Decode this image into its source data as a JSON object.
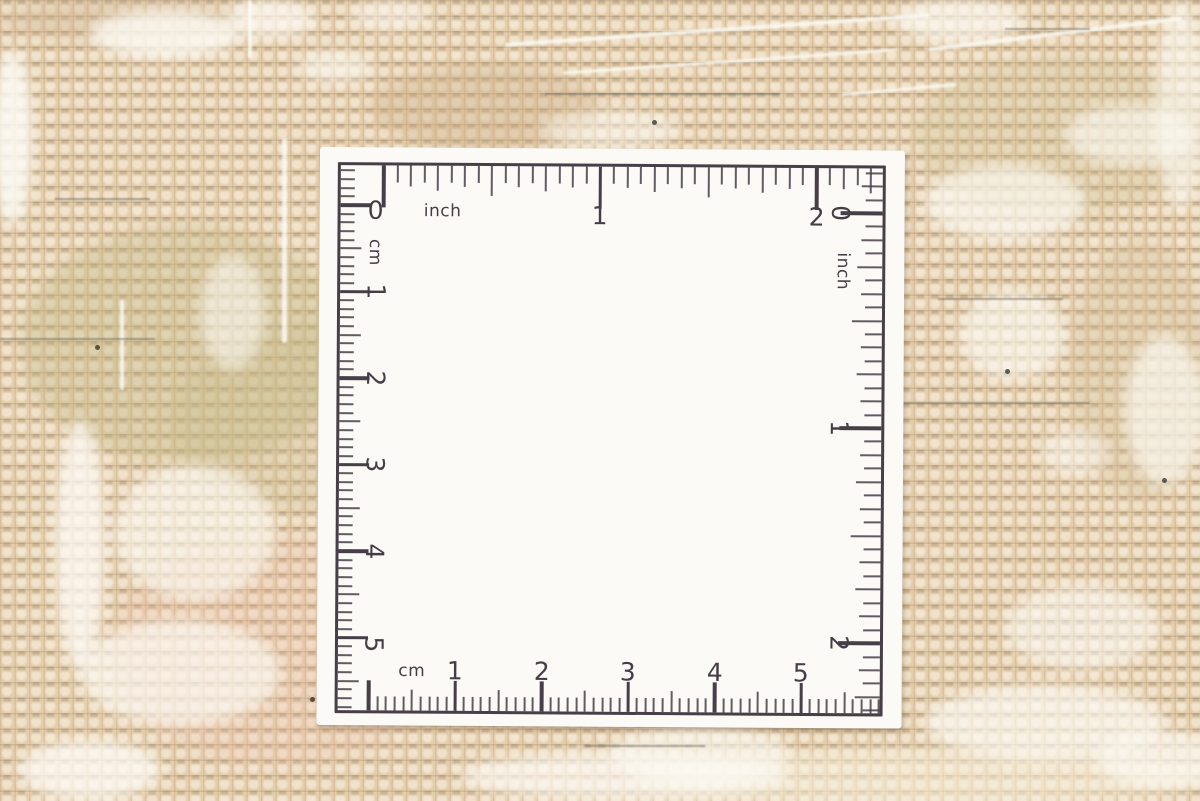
{
  "ruler_card": {
    "scales": {
      "top": {
        "unit": "inch",
        "numbers": [
          "0",
          "1",
          "2"
        ]
      },
      "right": {
        "unit": "inch",
        "numbers": [
          "0",
          "1",
          "2"
        ]
      },
      "left": {
        "unit": "cm",
        "numbers": [
          "1",
          "2",
          "3",
          "4",
          "5"
        ]
      },
      "bottom": {
        "unit": "cm",
        "numbers": [
          "1",
          "2",
          "3",
          "4",
          "5"
        ]
      }
    },
    "colors": {
      "card": "#fbfaf7",
      "ink": "#473f48"
    }
  },
  "carpet": {
    "colors": {
      "base": "#e4cdab",
      "white_yarn": "#fbf9f3",
      "weft_line": "#6f756b"
    }
  }
}
